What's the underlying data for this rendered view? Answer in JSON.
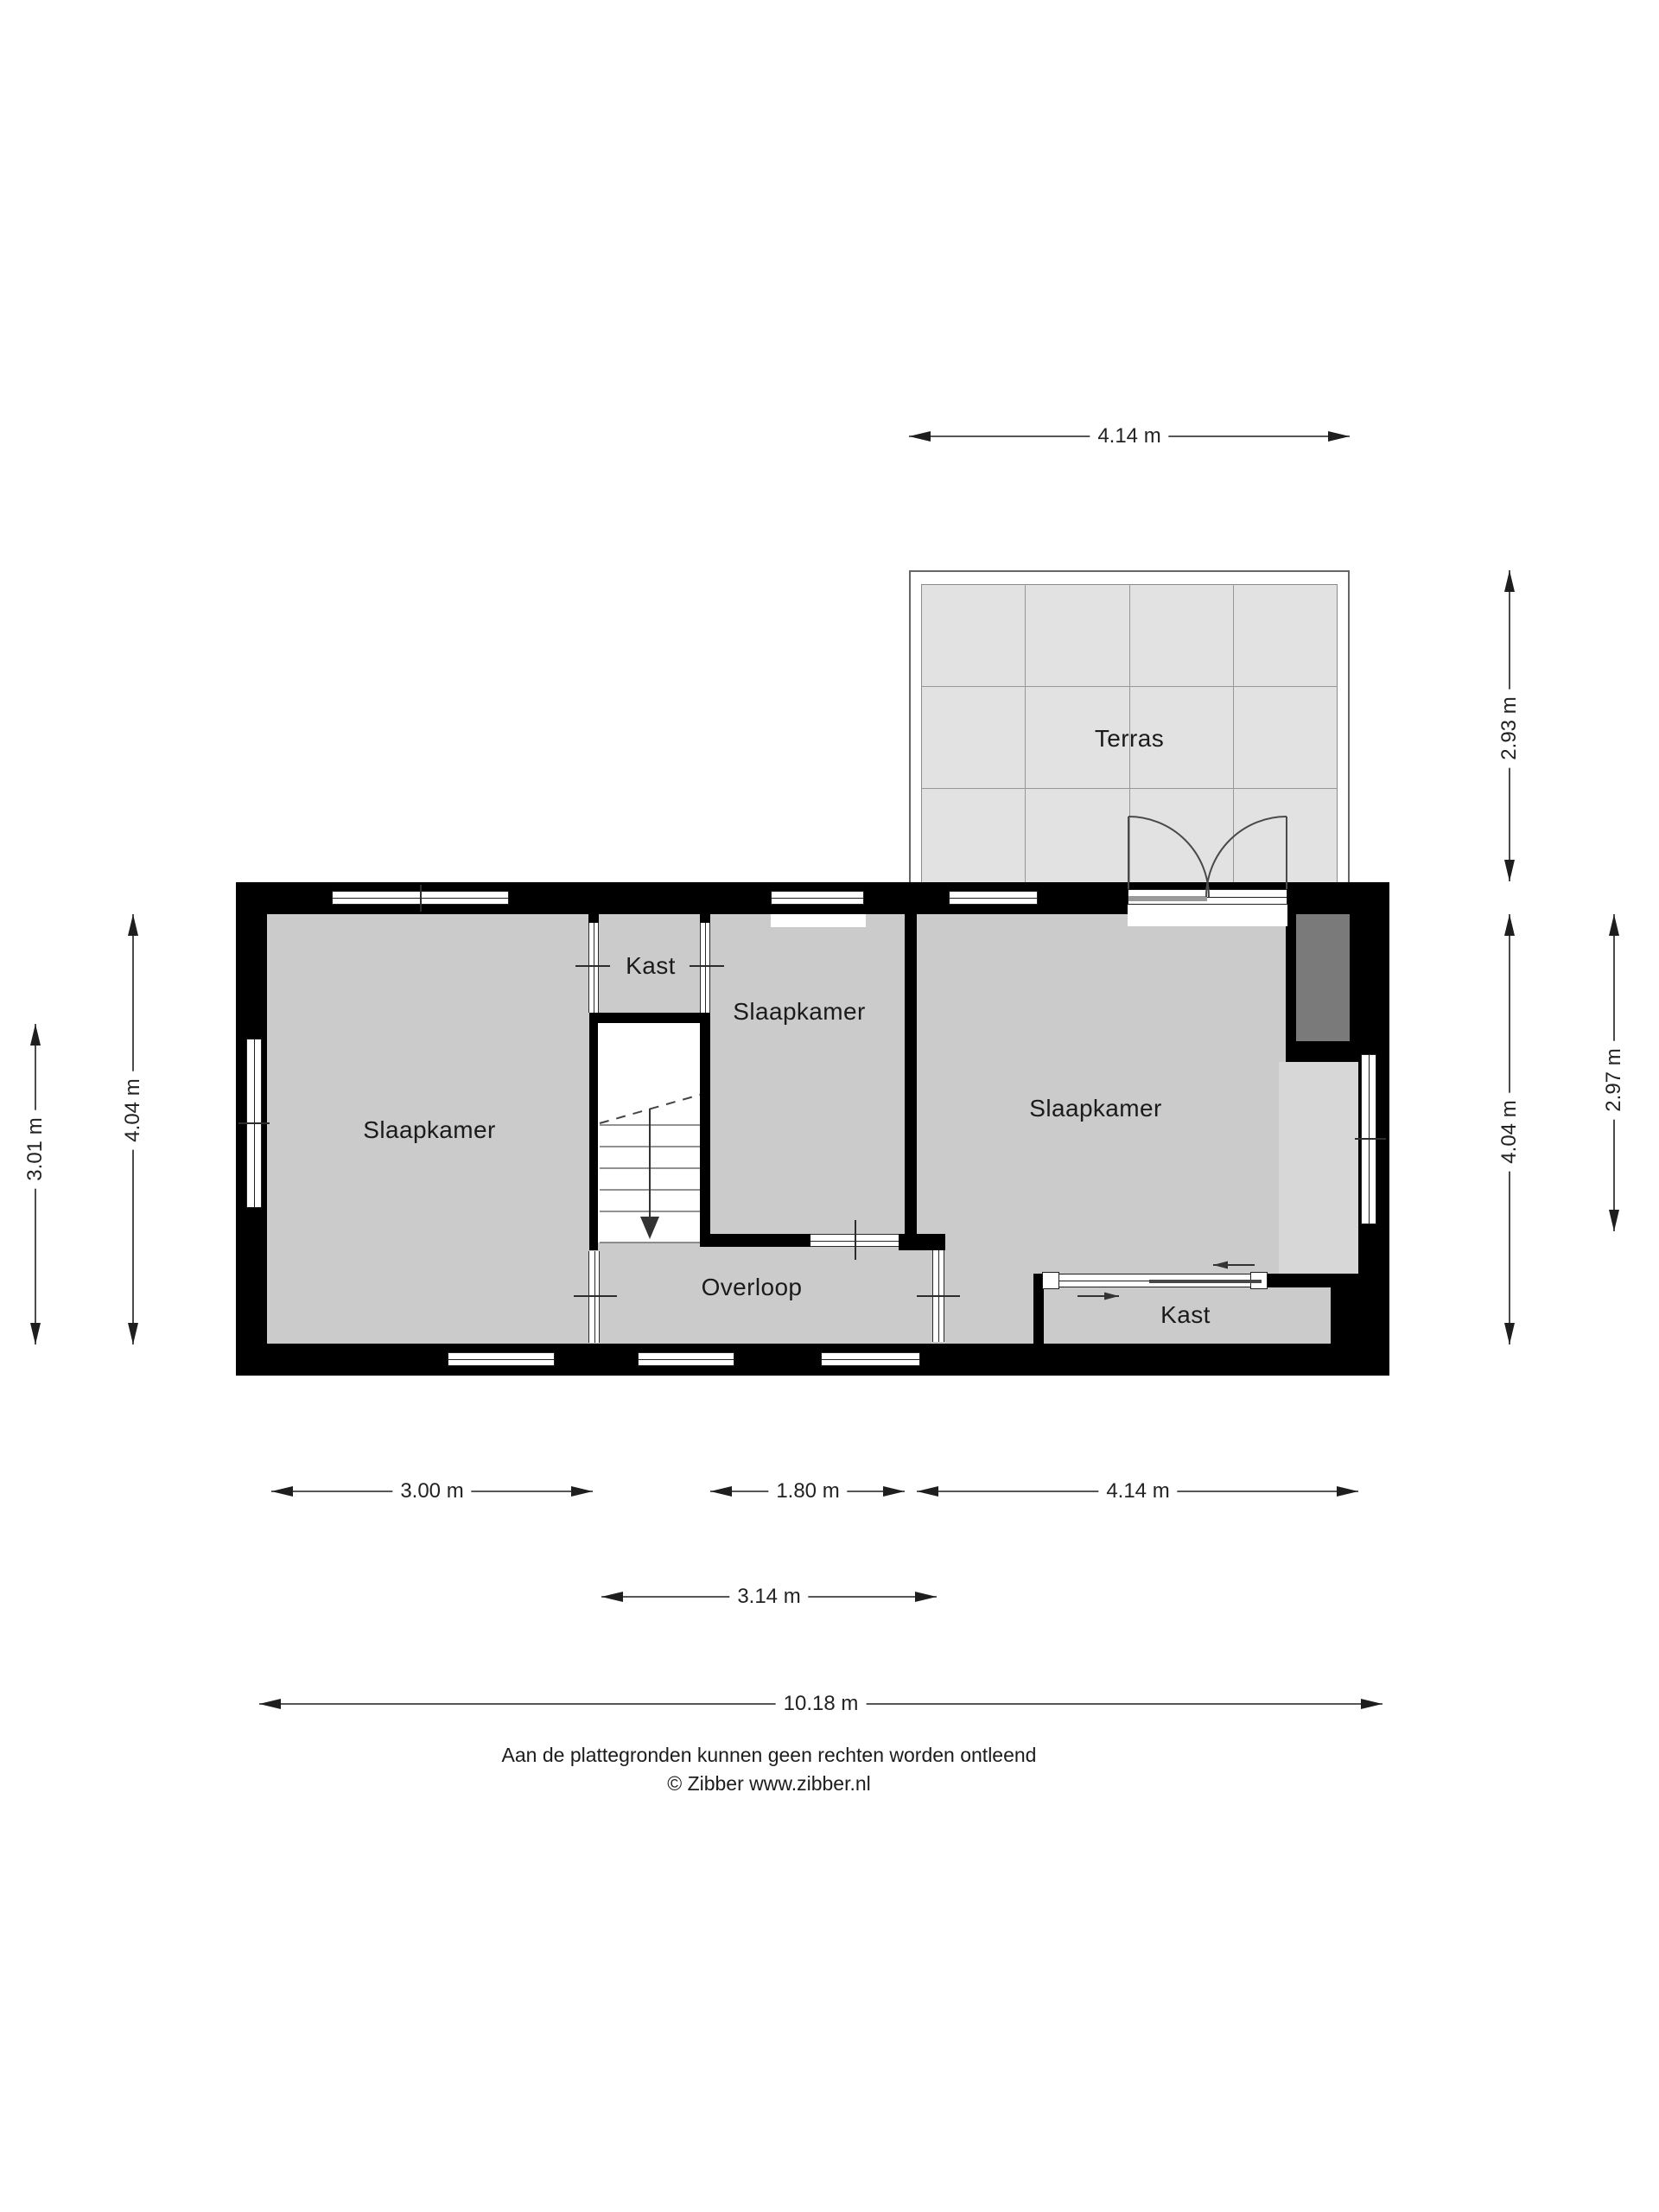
{
  "plan": {
    "type": "floorplan",
    "provider_note": "Aan de plattegronden kunnen geen rechten worden ontleend",
    "copyright": "© Zibber www.zibber.nl"
  },
  "rooms": {
    "terras": "Terras",
    "kast_top": "Kast",
    "bedroom_left": "Slaapkamer",
    "bedroom_middle": "Slaapkamer",
    "bedroom_right": "Slaapkamer",
    "landing": "Overloop",
    "kast_bottom": "Kast"
  },
  "dims": {
    "terras_width": "4.14 m",
    "terras_height": "2.93 m",
    "right_inner": "4.04 m",
    "right_outer": "2.97 m",
    "left_inner": "4.04 m",
    "left_outer": "3.01 m",
    "bottom_left_room": "3.00 m",
    "bottom_stairwell": "1.80 m",
    "bottom_right_room": "4.14 m",
    "bottom_mid_span": "3.14 m",
    "bottom_total": "10.18 m"
  },
  "footer": {
    "line1": "Aan de plattegronden kunnen geen rechten worden ontleend",
    "line2": "© Zibber www.zibber.nl"
  },
  "colors": {
    "wall": "#000000",
    "room_fill": "#cbcbcb",
    "terras_fill": "#e2e2e2",
    "shaft_fill": "#7a7a7a",
    "ceiling_strip": "#d7d7d7"
  }
}
